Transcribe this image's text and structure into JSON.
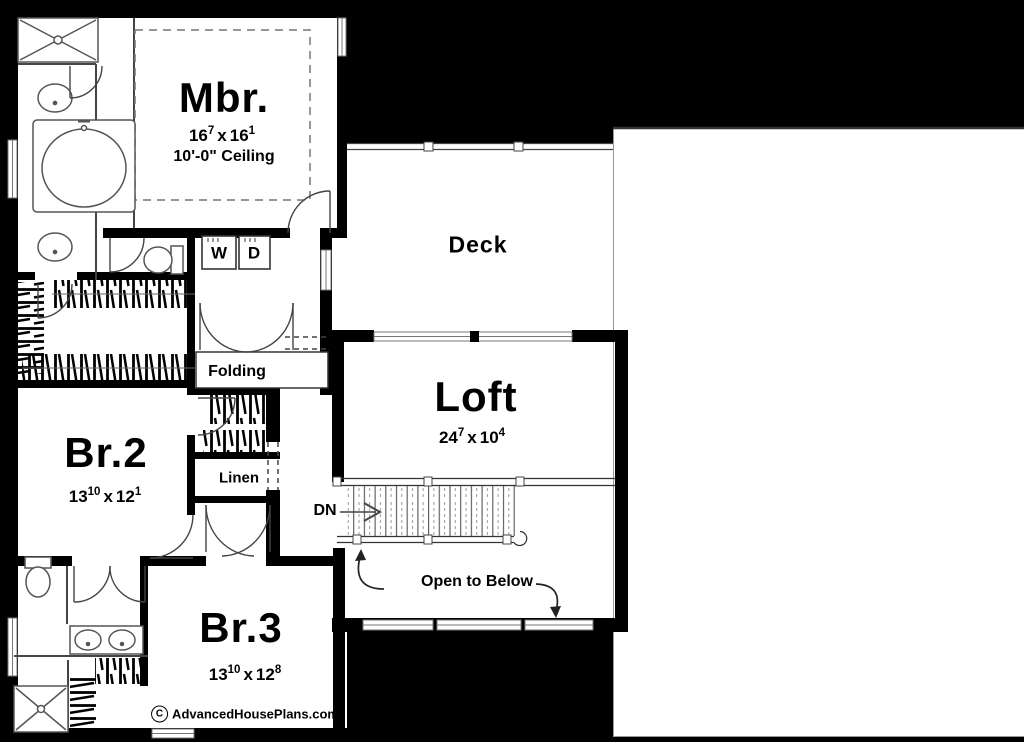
{
  "plan": {
    "title": "Second floor plan",
    "rooms": {
      "mbr": {
        "label": "Mbr.",
        "ceiling": "10'-0\" Ceiling",
        "dims": {
          "a": "16",
          "asup": "7",
          "sep": "x",
          "b": "16",
          "bsup": "1"
        }
      },
      "deck": {
        "label": "Deck"
      },
      "loft": {
        "label": "Loft",
        "dims": {
          "a": "24",
          "asup": "7",
          "sep": "x",
          "b": "10",
          "bsup": "4"
        }
      },
      "br2": {
        "label": "Br.2",
        "dims": {
          "a": "13",
          "asup": "10",
          "sep": "x",
          "b": "12",
          "bsup": "1"
        }
      },
      "br3": {
        "label": "Br.3",
        "dims": {
          "a": "13",
          "asup": "10",
          "sep": "x",
          "b": "12",
          "bsup": "8"
        }
      },
      "linen": {
        "label": "Linen"
      },
      "folding": {
        "label": "Folding"
      }
    },
    "laundry": {
      "washer": "W",
      "dryer": "D"
    },
    "stairs": {
      "down_label": "DN",
      "open_label": "Open to Below"
    },
    "watermark": {
      "symbol": "C",
      "text": "AdvancedHousePlans.com"
    },
    "colors": {
      "background": "#000000",
      "wall": "#000000",
      "floor": "#ffffff",
      "thin_line": "#555555",
      "rail": "#888888"
    }
  }
}
